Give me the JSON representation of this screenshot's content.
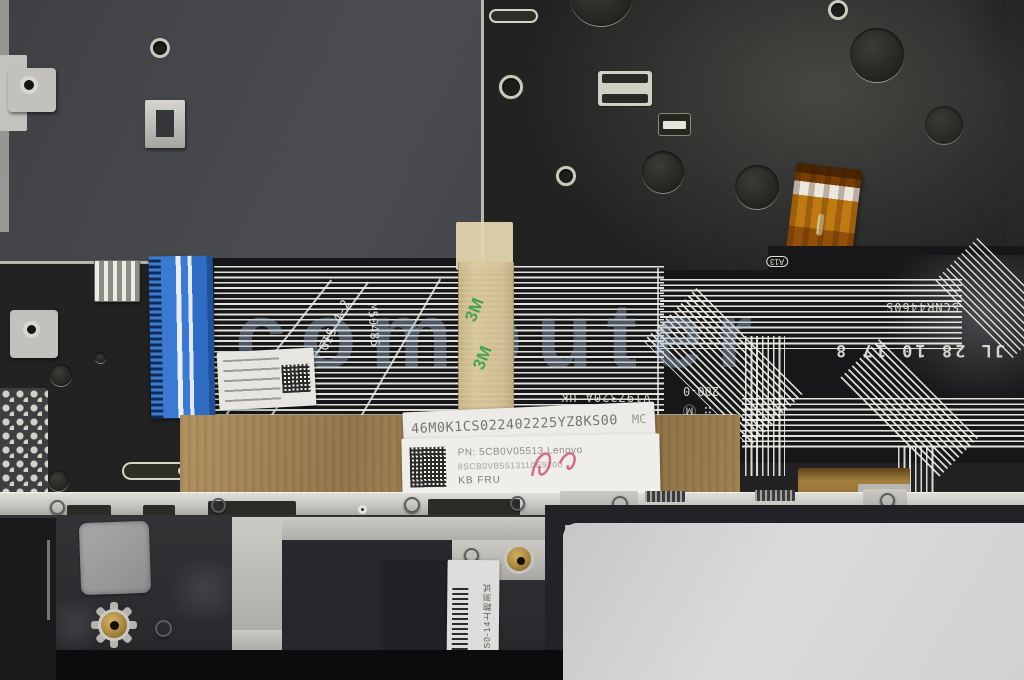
{
  "photo": {
    "watermark": "computer"
  },
  "keyboard_flex": {
    "serial_strip": "46M0K1CS022402225YZ8KS00",
    "serial_suffix": "MC",
    "stamps": {
      "plant_code": "SCNR4460S",
      "date_code": "JL 28 10 17 8",
      "membrane_code": "V19Z320A UK",
      "counter": "200-0",
      "inspection_marks": "∷ Ⓜ",
      "a13": "A13",
      "gis_mark": "GIS 4-2",
      "m_code": "M50485"
    },
    "tape_brand": "3M"
  },
  "labels": {
    "part_number": {
      "line1": "PN: 5CB0V05513   Lenovo",
      "line2": "8SCB0VB5513110E9200",
      "line3": "KB FRU"
    },
    "test_label_vertical": "01 LCS0-14上跑测试"
  },
  "colors": {
    "plate_olive": "#767857",
    "panel_dark": "#46474b",
    "membrane_black": "#17171a",
    "connector_blue": "#3b7ad0",
    "tape_tan": "#d5c298",
    "bronze": "#ab8c5a",
    "backlight_amber": "#c07a14",
    "trackpad_white": "#d6d6d8"
  }
}
